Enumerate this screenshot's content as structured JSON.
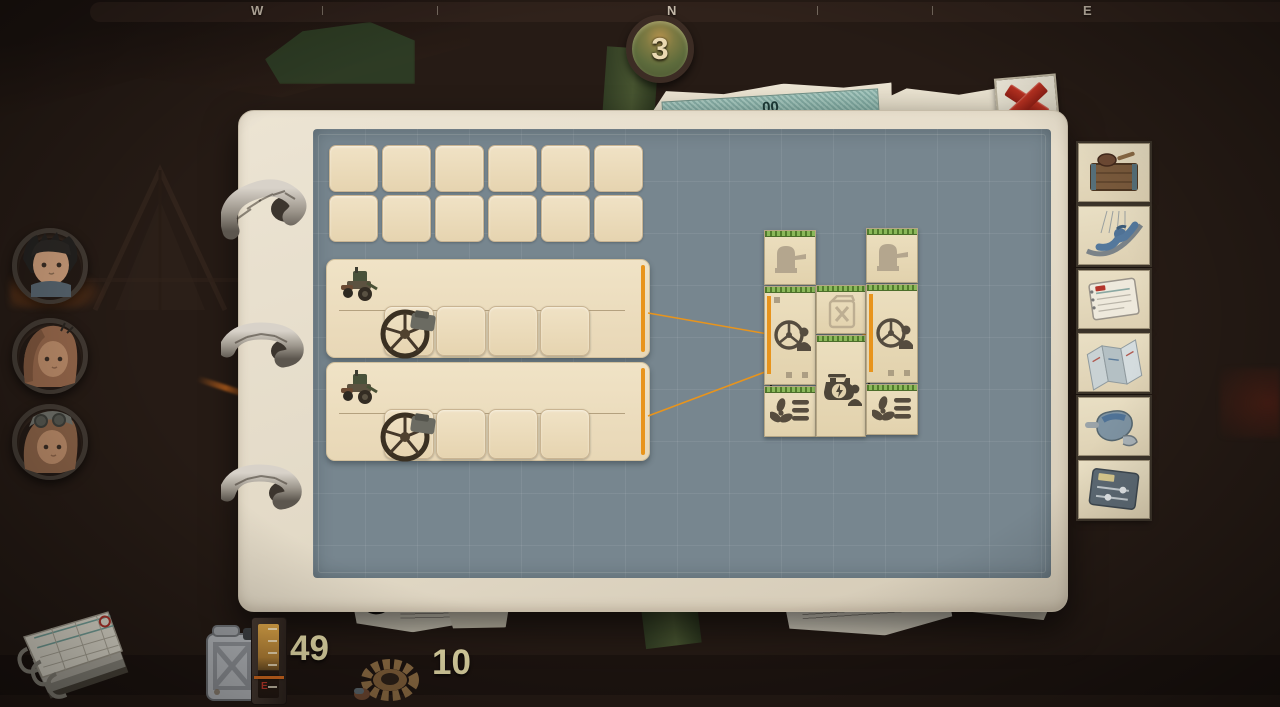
{
  "compass": {
    "west": "W",
    "north": "N",
    "east": "E"
  },
  "day_badge": {
    "value": "3"
  },
  "banknote": {
    "digits": "00"
  },
  "crew": {
    "portraits": [
      "boy-spiky-hair",
      "hooded-traveler",
      "goggles-traveler"
    ]
  },
  "inventory_grid": {
    "columns": 6,
    "rows": 2
  },
  "vehicle_rows": [
    {
      "icon": "tractor",
      "slots": 4,
      "filled_slot_icon": "spoked-wheel"
    },
    {
      "icon": "tractor",
      "slots": 4,
      "filled_slot_icon": "spoked-wheel"
    }
  ],
  "caravan_modules": {
    "left_column": [
      "turret",
      "steering-station",
      "ventilation"
    ],
    "center_column": [
      "fuel-empty",
      "engine-station"
    ],
    "right_column": [
      "turret",
      "steering-station",
      "ventilation"
    ]
  },
  "sidebar": {
    "items": [
      "storage-crate",
      "hammock",
      "checklist-pad",
      "blueprint-map",
      "repair-glove",
      "control-panel"
    ]
  },
  "resources": {
    "fuel": "49",
    "gears": "10",
    "gauge_empty_label": "E"
  },
  "colors": {
    "accent_orange": "#e8941c",
    "module_green": "#79a844",
    "page_blue": "#77868f",
    "paper_cream": "#efe3c8",
    "alert_red": "#b1251c"
  }
}
